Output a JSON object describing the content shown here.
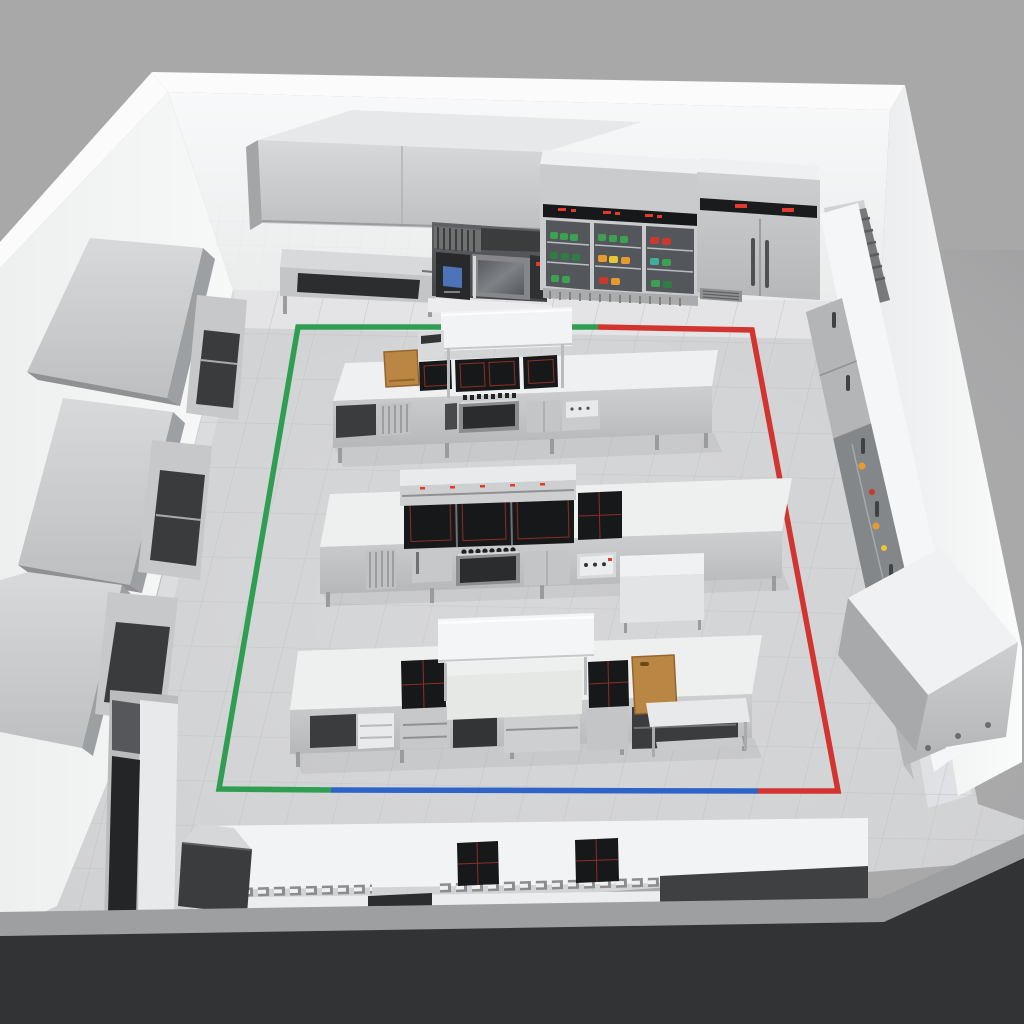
{
  "meta": {
    "title": "Commercial kitchen 3D layout render",
    "view": "isometric cutaway room, no visible text labels"
  },
  "palette": {
    "background": "#a8a8a9",
    "floor": "#d2d3d5",
    "floor_grout": "#c2c3c6",
    "floor_near_wall": "#e9eaec",
    "wall": "#f2f3f4",
    "wall_edge": "#fbfbfc",
    "cut_wall_face": "#323334",
    "cut_wall_top": "#9e9fa0",
    "stainless": "#c6c8ca",
    "stainless_dark": "#9a9c9e",
    "counter_white": "#eff0f1",
    "cooktop_black": "#17181a",
    "cooktop_zone_red": "#8c2f24",
    "wood": "#b98743",
    "wood_edge": "#96652e",
    "screen_blue": "#4d74b8",
    "led_red": "#e23b2e",
    "menu_board_dark": "#3a3c3e",
    "food_green": "#3da152",
    "food_dark_green": "#2e7d42",
    "food_orange": "#e69b2c",
    "food_yellow": "#e8c63a",
    "food_red": "#c9392e",
    "food_teal": "#3fae9a"
  },
  "workflow_lines": {
    "green": {
      "color": "#2f9e52",
      "segment": "left side and top-left perimeter of work zone"
    },
    "red": {
      "color": "#d23430",
      "segment": "top-right and right perimeter of work zone"
    },
    "blue": {
      "color": "#2e63c8",
      "segment": "front (bottom) perimeter of work zone"
    }
  },
  "equipment": {
    "top_wall_row": [
      "exhaust-hood",
      "prep-table-open-base",
      "combi-oven-stack",
      "open-shelf-rack",
      "glass-door-display-fridge",
      "double-door-upright-fridge"
    ],
    "left_wall_row": [
      "wall-cabinet-1",
      "wall-cabinet-2",
      "wall-cabinet-3",
      "shelving-rack",
      "work-table-undershelf-1",
      "work-table-undershelf-2",
      "tall-storage-cabinet"
    ],
    "right_wall_row": [
      "vent-top-cabinet",
      "refrigerated-cabinet-run",
      "glass-door-food-cabinets",
      "stainless-chest-unit"
    ],
    "islands": [
      {
        "name": "cooking-island-1",
        "items": [
          "cutting-board",
          "induction-cooktops-3",
          "under-oven",
          "overhead-pass-shelf",
          "salamander"
        ]
      },
      {
        "name": "cooking-island-2",
        "items": [
          "induction-range-4-panel",
          "under-oven",
          "overhead-heat-gantry",
          "control-box",
          "side-cabinet"
        ]
      },
      {
        "name": "cooking-island-3",
        "items": [
          "induction-hob-left",
          "induction-hob-right",
          "center-pass-shelf",
          "cutting-board",
          "drawer-units",
          "open-shelves"
        ]
      }
    ],
    "front_counter": {
      "name": "service-counter",
      "items": [
        "menu-display-board",
        "induction-hob-1",
        "induction-hob-2",
        "vent-grilles",
        "under-counter-dark-units"
      ]
    },
    "misc": [
      "small-side-table"
    ]
  },
  "fridge_panel": {
    "led_count_display_fridge": 3,
    "led_count_double_fridge": 2
  }
}
